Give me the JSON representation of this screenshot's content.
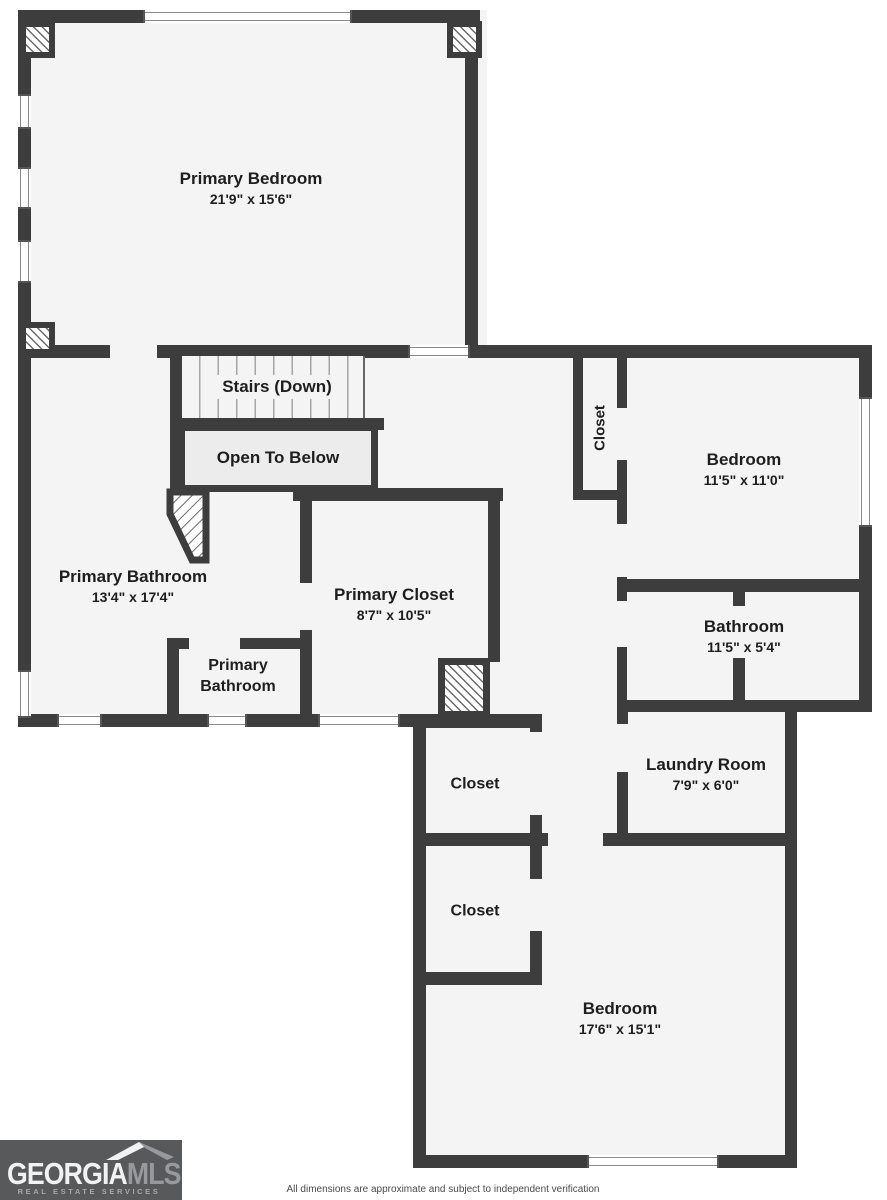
{
  "floorplan": {
    "title": "Upper floor plan",
    "colors": {
      "wall": "#3d3d3d",
      "floor": "#f4f4f4",
      "open_to_below_fill": "#ececec",
      "logo_bg": "#58595b"
    },
    "rooms": [
      {
        "name": "Primary Bedroom",
        "dims": "21'9\" x 15'6\""
      },
      {
        "name": "Stairs (Down)",
        "dims": ""
      },
      {
        "name": "Open To Below",
        "dims": ""
      },
      {
        "name": "Closet",
        "dims": ""
      },
      {
        "name": "Bedroom",
        "dims": "11'5\" x 11'0\""
      },
      {
        "name": "Primary Bathroom",
        "dims": "13'4\" x 17'4\""
      },
      {
        "name": "Primary Closet",
        "dims": "8'7\" x 10'5\""
      },
      {
        "name": "Primary Bathroom",
        "dims": ""
      },
      {
        "name": "Bathroom",
        "dims": "11'5\" x 5'4\""
      },
      {
        "name": "Laundry Room",
        "dims": "7'9\" x 6'0\""
      },
      {
        "name": "Closet",
        "dims": ""
      },
      {
        "name": "Closet",
        "dims": ""
      },
      {
        "name": "Bedroom",
        "dims": "17'6\" x 15'1\""
      }
    ]
  },
  "footer": {
    "logo": {
      "brand_primary": "GEORGIA",
      "brand_secondary": "MLS",
      "tagline": "REAL ESTATE SERVICES"
    },
    "disclaimer": "All dimensions are approximate and subject to independent verification"
  }
}
